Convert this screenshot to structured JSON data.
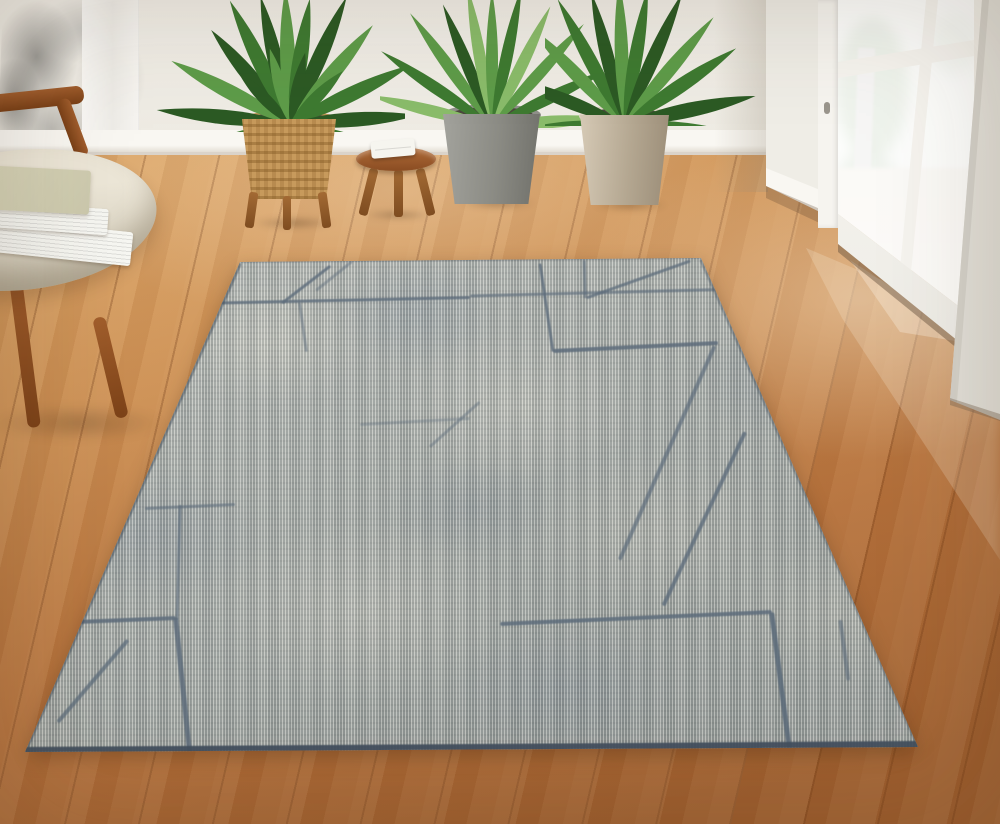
{
  "meta": {
    "description": "Sunlit living room with a gray abstract-pattern area rug on warm oak wood flooring, cream lounge chair with stacked books, three potted green plants, a small wooden stool with folded white cloth, and an open white French glass door"
  },
  "palette": {
    "wall": "#f2efe8",
    "baseboard": "#f9f7f2",
    "floor_top": "#dba568",
    "floor_deep": "#a06030",
    "rug_base": "#b4b8b1",
    "rug_ivory": "#d9d7ca",
    "rug_slate": "#8794a0",
    "rug_line": "#5d6c7b",
    "rug_binding": "#43505e",
    "chair_wood": "#a05d2d",
    "chair_wood_dark": "#7a4017",
    "seat": "#ece6d7",
    "seat_shadow": "#cfc8b6",
    "book_white": "#f8f8f3",
    "book_sage": "#d9d6ba",
    "cloth": "#f6f5ef",
    "wicker": "#c79a5c",
    "pot_soil": "#4c473e",
    "pot_gray": "#90908a",
    "pot_beige": "#e0d7c7",
    "leaf_dark": "#2c5a24",
    "leaf_mid": "#3e7a31",
    "leaf_light": "#5e9c49",
    "leaf_pale": "#8abc6a",
    "stem": "#b9cc90",
    "door_white": "#f6f4ef",
    "exterior": "#f3f6ee",
    "ext_green": "#86a873",
    "ext_green_dark": "#5f8a50",
    "ext_ground": "#e6dcc8",
    "ext_post": "#c6c4bf"
  },
  "scene": {
    "rug": {
      "polygon": [
        [
          240,
          262
        ],
        [
          701,
          258
        ],
        [
          918,
          747
        ],
        [
          25,
          752
        ]
      ],
      "pattern_lines": [
        {
          "x1": 330,
          "y1": 266,
          "x2": 282,
          "y2": 303,
          "w": 3,
          "o": 0.8
        },
        {
          "x1": 352,
          "y1": 262,
          "x2": 316,
          "y2": 291,
          "w": 2.5,
          "o": 0.45
        },
        {
          "x1": 196,
          "y1": 303,
          "x2": 470,
          "y2": 297,
          "w": 3,
          "o": 0.8
        },
        {
          "x1": 470,
          "y1": 296,
          "x2": 740,
          "y2": 289,
          "w": 2.5,
          "o": 0.65
        },
        {
          "x1": 690,
          "y1": 261,
          "x2": 586,
          "y2": 298,
          "w": 3,
          "o": 0.75
        },
        {
          "x1": 585,
          "y1": 260,
          "x2": 586,
          "y2": 298,
          "w": 2.5,
          "o": 0.6
        },
        {
          "x1": 540,
          "y1": 263,
          "x2": 553,
          "y2": 351,
          "w": 3,
          "o": 0.8
        },
        {
          "x1": 553,
          "y1": 351,
          "x2": 718,
          "y2": 343,
          "w": 3.5,
          "o": 0.85
        },
        {
          "x1": 715,
          "y1": 346,
          "x2": 620,
          "y2": 560,
          "w": 4,
          "o": 0.7
        },
        {
          "x1": 745,
          "y1": 432,
          "x2": 663,
          "y2": 606,
          "w": 4,
          "o": 0.8
        },
        {
          "x1": 145,
          "y1": 508,
          "x2": 235,
          "y2": 504,
          "w": 3,
          "o": 0.6
        },
        {
          "x1": 180,
          "y1": 505,
          "x2": 177,
          "y2": 620,
          "w": 3,
          "o": 0.65
        },
        {
          "x1": 28,
          "y1": 624,
          "x2": 176,
          "y2": 618,
          "w": 4,
          "o": 0.85
        },
        {
          "x1": 176,
          "y1": 618,
          "x2": 190,
          "y2": 753,
          "w": 4.5,
          "o": 0.85
        },
        {
          "x1": 500,
          "y1": 624,
          "x2": 772,
          "y2": 612,
          "w": 4,
          "o": 0.85
        },
        {
          "x1": 772,
          "y1": 612,
          "x2": 790,
          "y2": 750,
          "w": 5,
          "o": 0.9
        },
        {
          "x1": 128,
          "y1": 640,
          "x2": 58,
          "y2": 722,
          "w": 4,
          "o": 0.75
        },
        {
          "x1": 300,
          "y1": 302,
          "x2": 307,
          "y2": 352,
          "w": 2.5,
          "o": 0.5
        },
        {
          "x1": 480,
          "y1": 402,
          "x2": 430,
          "y2": 447,
          "w": 3,
          "o": 0.45
        },
        {
          "x1": 360,
          "y1": 424,
          "x2": 470,
          "y2": 418,
          "w": 2.5,
          "o": 0.35
        },
        {
          "x1": 840,
          "y1": 620,
          "x2": 848,
          "y2": 680,
          "w": 4,
          "o": 0.6
        },
        {
          "x1": 25,
          "y1": 751,
          "x2": 918,
          "y2": 745,
          "w": 8,
          "o": 0.95,
          "c": "rug_binding"
        },
        {
          "x1": 240,
          "y1": 263,
          "x2": 25,
          "y2": 751,
          "w": 4,
          "o": 0.55,
          "c": "rug_binding"
        },
        {
          "x1": 240,
          "y1": 262,
          "x2": 701,
          "y2": 258,
          "w": 2,
          "o": 0.35,
          "c": "rug_binding"
        },
        {
          "x1": 701,
          "y1": 259,
          "x2": 918,
          "y2": 745,
          "w": 3,
          "o": 0.4,
          "c": "rug_binding"
        }
      ]
    }
  }
}
